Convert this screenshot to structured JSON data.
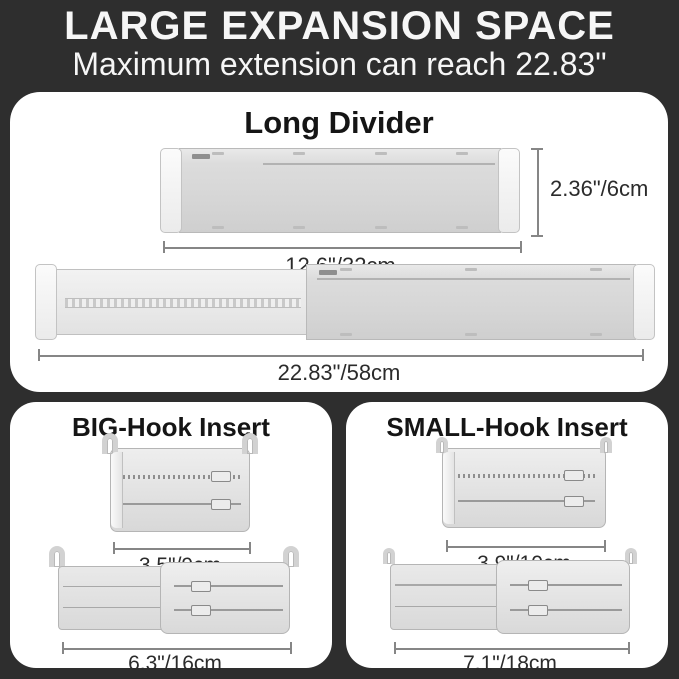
{
  "colors": {
    "background": "#2e2e2e",
    "panel": "#ffffff",
    "title_text": "#151515",
    "dimension_text": "#2b2b2b",
    "divider_body": "#d6d6d6",
    "divider_extension": "#ececec",
    "end_cap": "#f7f7f7",
    "dimension_line": "#868686"
  },
  "header": {
    "title": "LARGE EXPANSION SPACE",
    "subtitle": "Maximum extension can reach 22.83\""
  },
  "long_divider": {
    "title": "Long Divider",
    "height_label": "2.36\"/6cm",
    "compressed_width_label": "12.6\"/32cm",
    "extended_width_label": "22.83\"/58cm"
  },
  "big_hook": {
    "title": "BIG-Hook Insert",
    "compressed_label": "3.5\"/9cm",
    "extended_label": "6.3\"/16cm"
  },
  "small_hook": {
    "title": "SMALL-Hook Insert",
    "compressed_label": "3.9\"/10cm",
    "extended_label": "7.1\"/18cm"
  }
}
